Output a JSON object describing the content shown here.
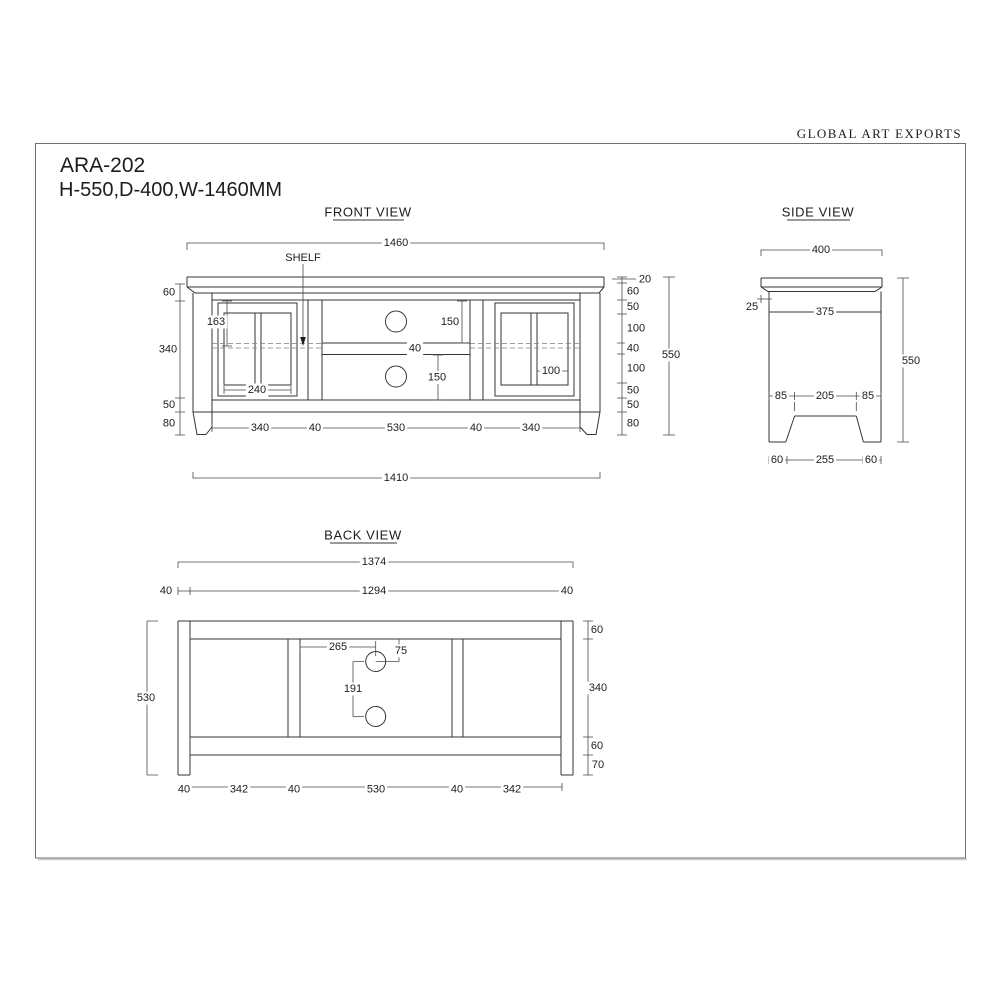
{
  "header": {
    "company": "GLOBAL ART EXPORTS",
    "model": "ARA-202",
    "dimensions_summary": "H-550,D-400,W-1460MM"
  },
  "front_view": {
    "title": "FRONT VIEW",
    "shelf_label": "SHELF",
    "width_top": "1460",
    "width_base": "1410",
    "top_thickness": "20",
    "height_total": "550",
    "left_stack": [
      "60",
      "340",
      "50",
      "80"
    ],
    "right_stack": [
      "60",
      "50",
      "100",
      "40",
      "100",
      "50",
      "50",
      "80"
    ],
    "door_top_to_shelf": "163",
    "door_glass_width": "240",
    "opening_upper": "150",
    "shelf_thickness": "40",
    "opening_lower": "150",
    "pane_width": "100",
    "bottom_row": [
      "340",
      "40",
      "530",
      "40",
      "340"
    ]
  },
  "side_view": {
    "title": "SIDE VIEW",
    "depth_total": "400",
    "top_overhang": "25",
    "depth_inner": "375",
    "height_total": "550",
    "mid_row": [
      "85",
      "205",
      "85"
    ],
    "bottom_row": [
      "60",
      "255",
      "60"
    ]
  },
  "back_view": {
    "title": "BACK VIEW",
    "width_total": "1374",
    "width_inner": "1294",
    "leg_left": "40",
    "leg_right": "40",
    "hole_offset_h": "265",
    "hole_offset_v": "75",
    "hole_gap": "191",
    "height_total": "530",
    "right_stack": [
      "60",
      "340",
      "60",
      "70"
    ],
    "bottom_row": [
      "40",
      "342",
      "40",
      "530",
      "40",
      "342"
    ]
  }
}
